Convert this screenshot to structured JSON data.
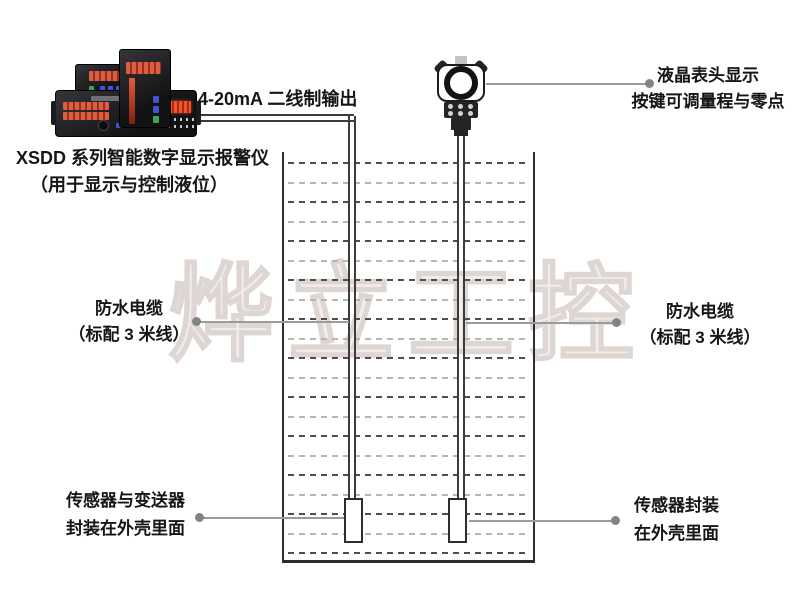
{
  "watermark": {
    "text": "烨立工控"
  },
  "labels": {
    "wire": "4-20mA 二线制输出",
    "instrument": {
      "line1": "XSDD 系列智能数字显示报警仪",
      "line2": "（用于显示与控制液位）"
    },
    "transmitter": {
      "line1": "液晶表头显示",
      "line2": "按键可调量程与零点"
    },
    "cable_left": {
      "line1": "防水电缆",
      "line2": "（标配 3 米线）"
    },
    "cable_right": {
      "line1": "防水电缆",
      "line2": "（标配 3 米线）"
    },
    "sensor_left": {
      "line1": "传感器与变送器",
      "line2": "封装在外壳里面"
    },
    "sensor_right": {
      "line1": "传感器封装",
      "line2": "在外壳里面"
    }
  },
  "colors": {
    "display_red": "#c8402e",
    "callout_gray": "#9b9b9b",
    "ink": "#161616",
    "watermark_outline": "#ded6d3"
  },
  "tank": {
    "liquid_row_count": 21
  }
}
